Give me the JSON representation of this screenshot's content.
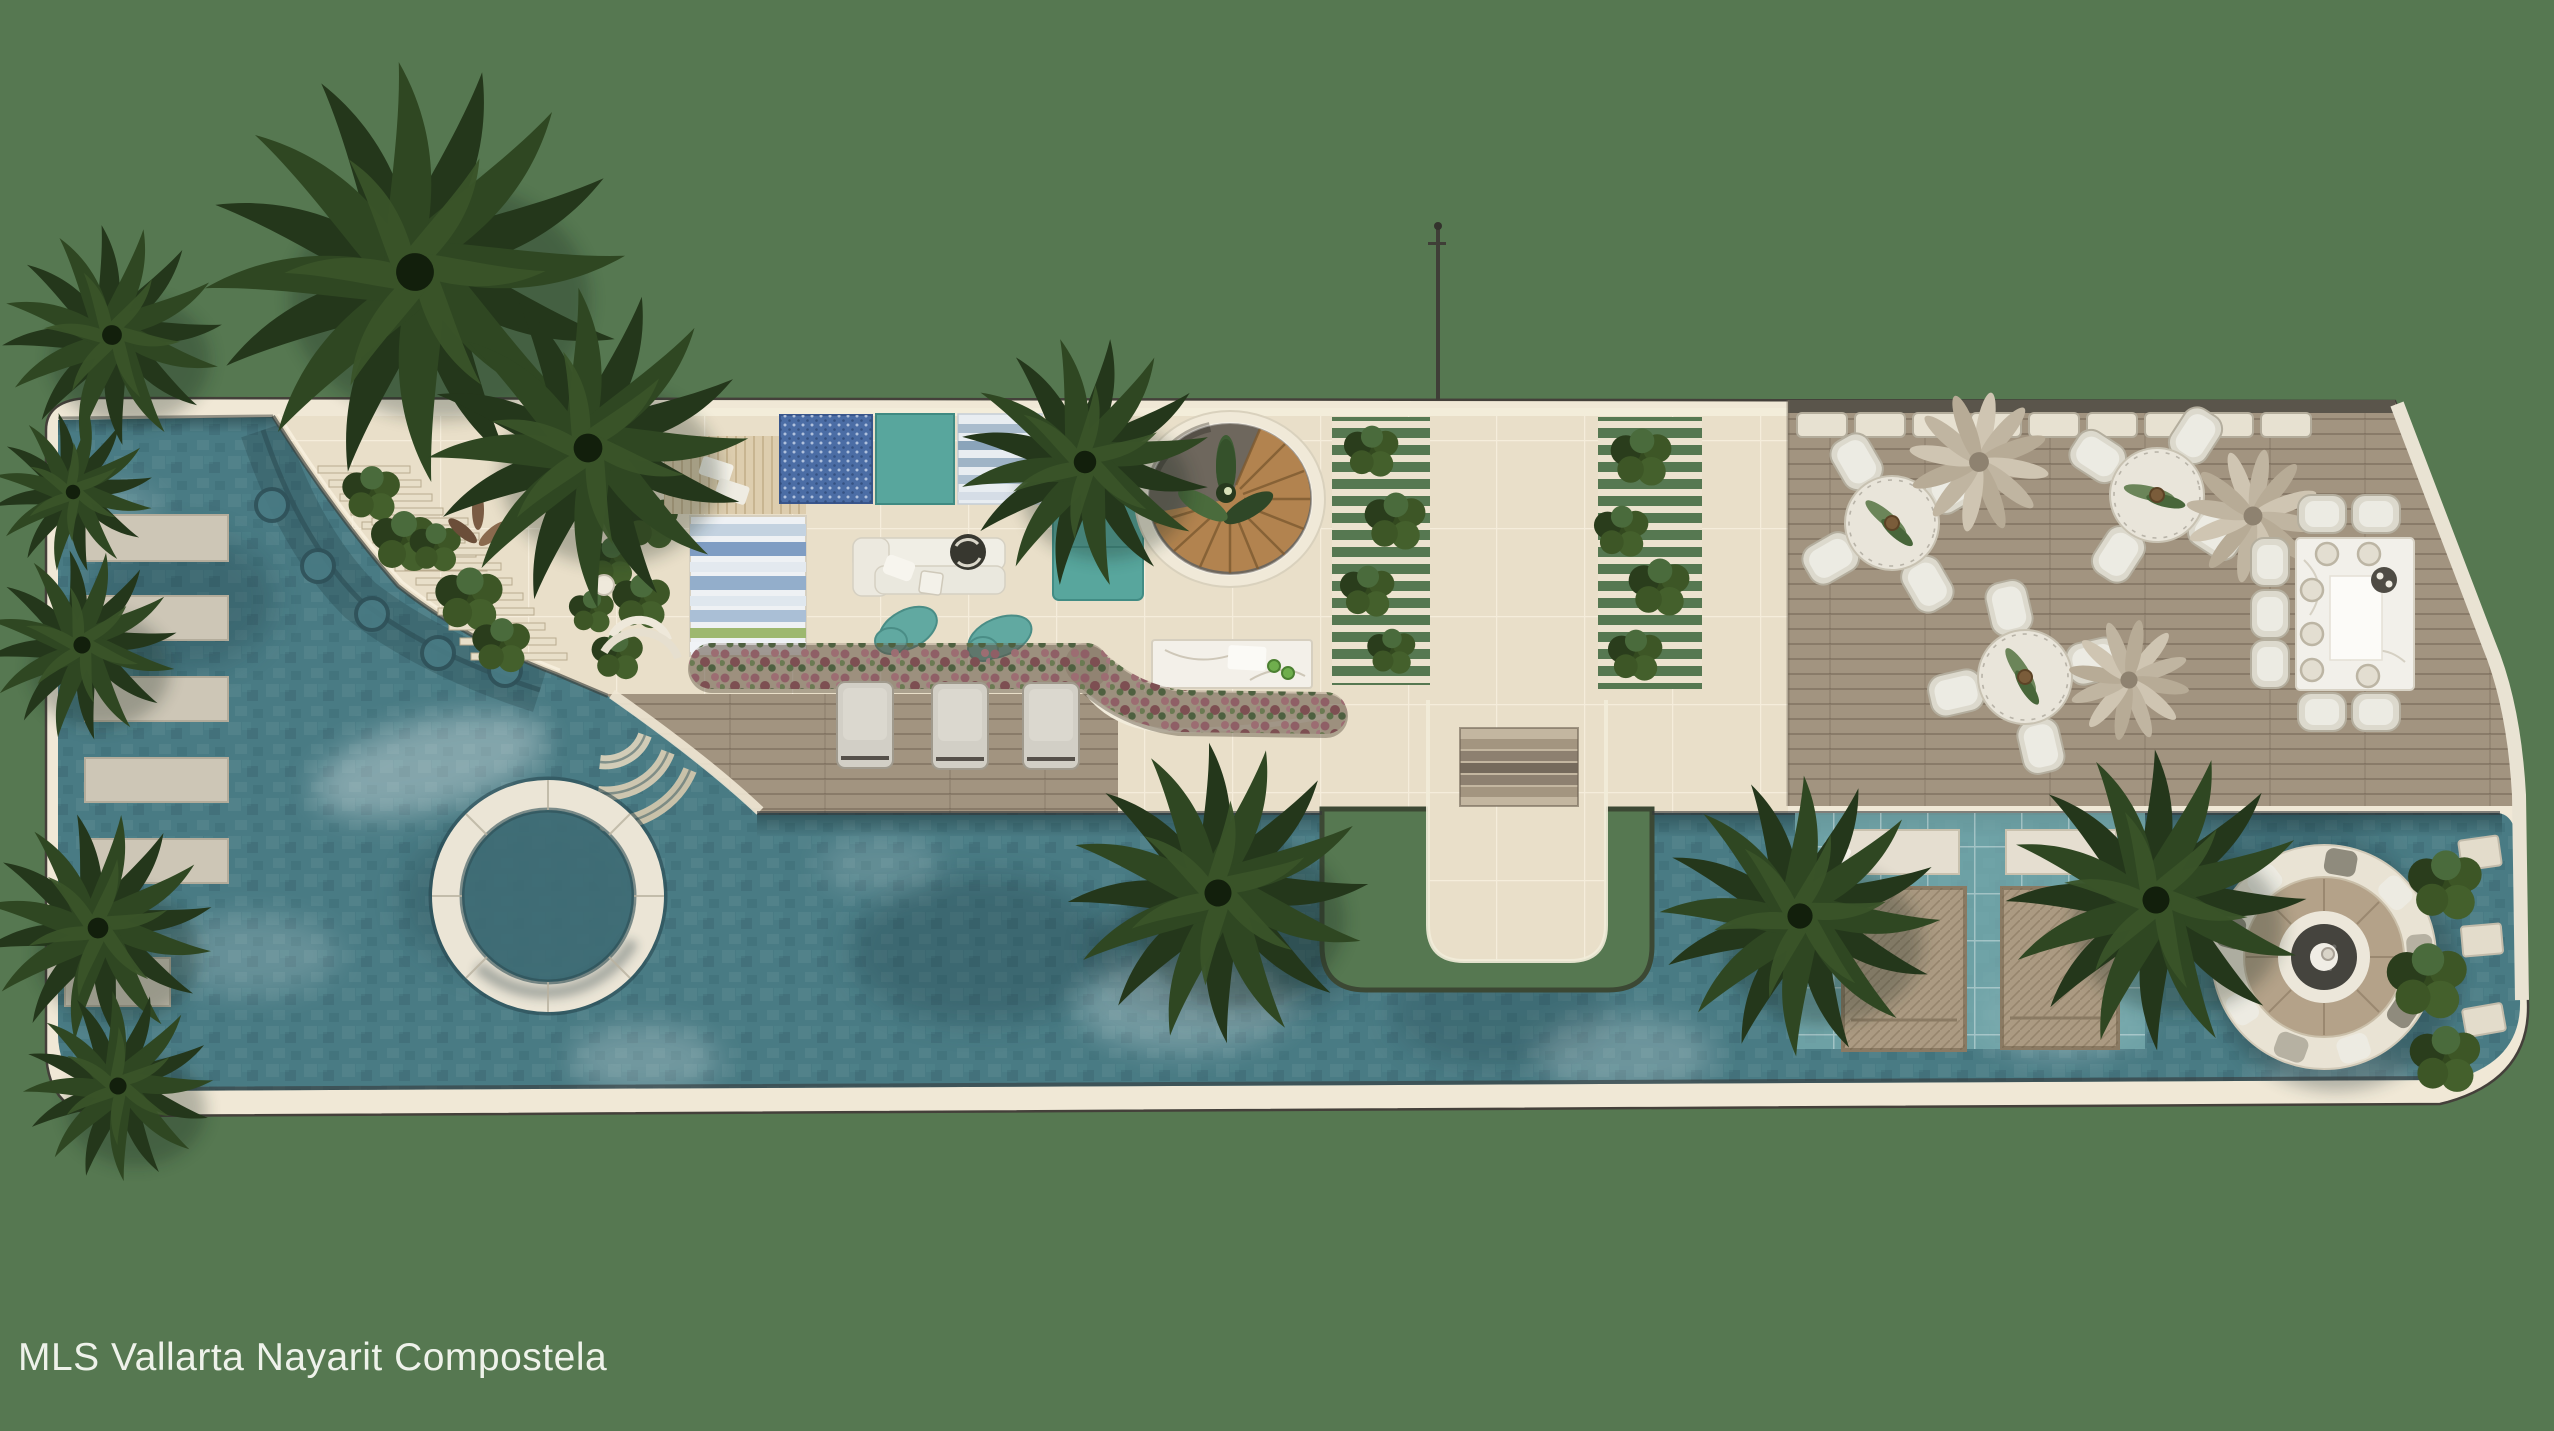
{
  "title": "Rooftop pool amenity deck - top-down architectural render",
  "watermark": {
    "text": "MLS Vallarta Nayarit Compostela",
    "color": "#eef2ea"
  },
  "palette": {
    "background": "#567851",
    "water": "#497b84",
    "water_dark": "#2e545d",
    "water_light": "#9cc6c6",
    "shallow_shelf": "#79aeb0",
    "tile": "#e9dfc9",
    "tile_border": "#f0e8d6",
    "wood_deck": "#a29480",
    "stair_wood": "#b2834f",
    "furniture_white": "#ece9de",
    "furniture_grey": "#cfccc2",
    "furniture_teal": "#58a69d",
    "rug_blue": "#4b6da5",
    "flower_bed": "#8f5f66",
    "palm_green": "#2b3f20",
    "trellis_slat": "#e8dfc9",
    "pool_edge_dark": "#35494d"
  },
  "scene": {
    "view": "plan view (top-down)",
    "areas": [
      {
        "id": "lap-pool",
        "label": "Main free-form pool with mosaic water texture"
      },
      {
        "id": "stepping-pads",
        "label": "Six stone stepping pads along left pool edge"
      },
      {
        "id": "spa-circle",
        "label": "Circular spa ring inside pool"
      },
      {
        "id": "curved-steps",
        "label": "Scalloped curved pool steps at upper-left terrace edge"
      },
      {
        "id": "lounge-terrace",
        "label": "Stone lounge terrace with rugs, sofa and poufs"
      },
      {
        "id": "spiral-staircase",
        "label": "Round opening with wooden spiral staircase and plant"
      },
      {
        "id": "pergola-gardens",
        "label": "Slatted trellis planters with greenery"
      },
      {
        "id": "walkway-bridge",
        "label": "Central stone walkway with steps crossing the pool"
      },
      {
        "id": "dining-deck",
        "label": "Timber dining deck with three round sets and one long table"
      },
      {
        "id": "wet-deck",
        "label": "Shallow wet deck with two in-water wicker daybeds"
      },
      {
        "id": "fire-pit-island",
        "label": "Circular sunken fire-pit lounge island in pool"
      }
    ],
    "furniture_counts": {
      "grey_loungers": 3,
      "teal_poufs": 2,
      "teal_daybed": 1,
      "round_dining_sets": 3,
      "seats_per_round_set": 4,
      "long_table_chairs": 7,
      "in_water_daybeds": 2,
      "stepping_pads_left": 6,
      "trellis_strips": 4,
      "palm_trees": 11,
      "decorative_dry_plants": 3
    }
  }
}
